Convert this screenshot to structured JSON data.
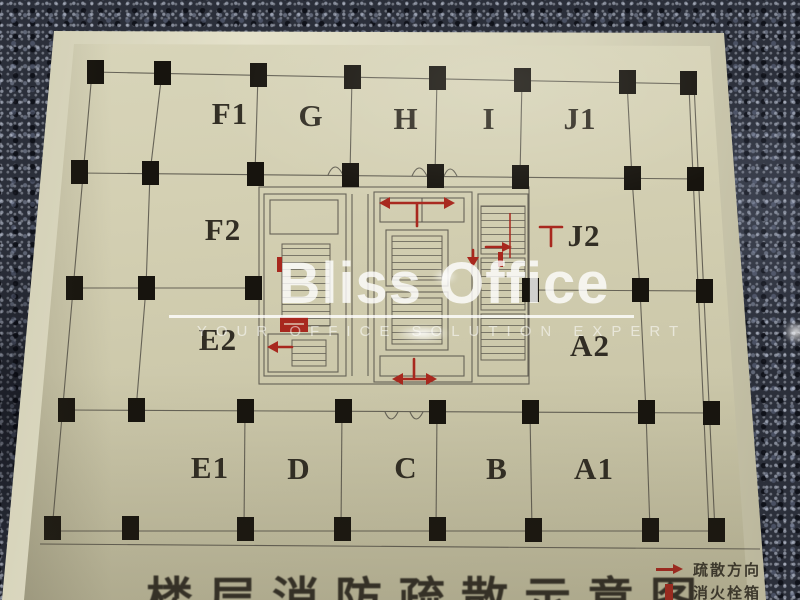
{
  "watermark": {
    "brand": "Bliss Office",
    "tagline": "YOUR OFFICE SOLUTION EXPERT"
  },
  "plan": {
    "title": "楼层消防疏散示意图",
    "zones": [
      {
        "label": "F1",
        "x": 230,
        "y": 114
      },
      {
        "label": "G",
        "x": 311,
        "y": 116
      },
      {
        "label": "H",
        "x": 406,
        "y": 119
      },
      {
        "label": "I",
        "x": 489,
        "y": 119
      },
      {
        "label": "J1",
        "x": 580,
        "y": 119
      },
      {
        "label": "F2",
        "x": 223,
        "y": 230
      },
      {
        "label": "J2",
        "x": 584,
        "y": 236
      },
      {
        "label": "E2",
        "x": 218,
        "y": 340
      },
      {
        "label": "A2",
        "x": 590,
        "y": 346
      },
      {
        "label": "E1",
        "x": 210,
        "y": 468
      },
      {
        "label": "D",
        "x": 299,
        "y": 469
      },
      {
        "label": "C",
        "x": 406,
        "y": 468
      },
      {
        "label": "B",
        "x": 497,
        "y": 469
      },
      {
        "label": "A1",
        "x": 594,
        "y": 469
      }
    ],
    "legend": {
      "items": [
        {
          "icon": "evacuation-direction-arrow",
          "label": "疏散方向"
        },
        {
          "icon": "fire-hydrant-box",
          "label": "消火栓箱"
        }
      ]
    }
  },
  "colors": {
    "board": "#d2ceb0",
    "granite": "#2b2f3a",
    "marking_red": "#a8281e",
    "line": "#5a564c",
    "column": "#17140e"
  }
}
